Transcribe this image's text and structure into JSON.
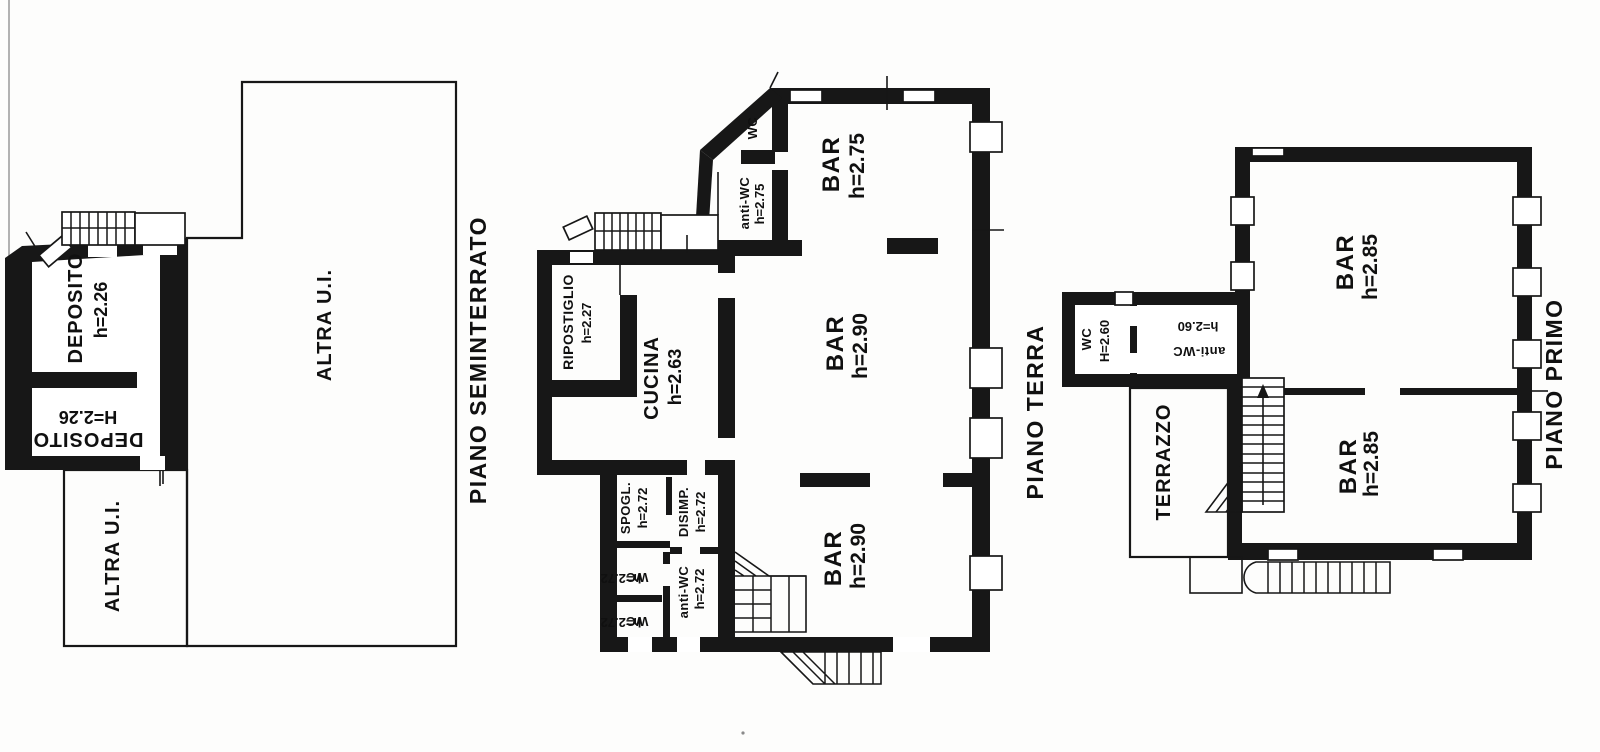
{
  "page": {
    "background": "#fdfdfc",
    "ink": "#171717"
  },
  "floors": [
    {
      "title": "PIANO SEMINTERRATO",
      "rooms": [
        {
          "name": "DEPOSITO",
          "height": "h=2.26"
        },
        {
          "name": "DEPOSITO",
          "height": "H=2.26"
        },
        {
          "name": "ALTRA U.I.",
          "height": ""
        },
        {
          "name": "ALTRA U.I.",
          "height": ""
        }
      ]
    },
    {
      "title": "PIANO TERRA",
      "rooms": [
        {
          "name": "WC",
          "height": ""
        },
        {
          "name": "anti-WC",
          "height": "h=2.75"
        },
        {
          "name": "BAR",
          "height": "h=2.75"
        },
        {
          "name": "RIPOSTIGLIO",
          "height": "h=2.27"
        },
        {
          "name": "CUCINA",
          "height": "h=2.63"
        },
        {
          "name": "BAR",
          "height": "h=2.90"
        },
        {
          "name": "SPOGL.",
          "height": "h=2.72"
        },
        {
          "name": "DISIMP.",
          "height": "h=2.72"
        },
        {
          "name": "WC",
          "height": "h=2.72"
        },
        {
          "name": "WC",
          "height": "h=2.72"
        },
        {
          "name": "anti-WC",
          "height": "h=2.72"
        },
        {
          "name": "BAR",
          "height": "h=2.90"
        }
      ]
    },
    {
      "title": "PIANO PRIMO",
      "rooms": [
        {
          "name": "WC",
          "height": "H=2.60"
        },
        {
          "name": "anti-WC",
          "height": "h=2.60"
        },
        {
          "name": "BAR",
          "height": "h=2.85"
        },
        {
          "name": "TERRAZZO",
          "height": ""
        },
        {
          "name": "BAR",
          "height": "h=2.85"
        }
      ]
    }
  ]
}
